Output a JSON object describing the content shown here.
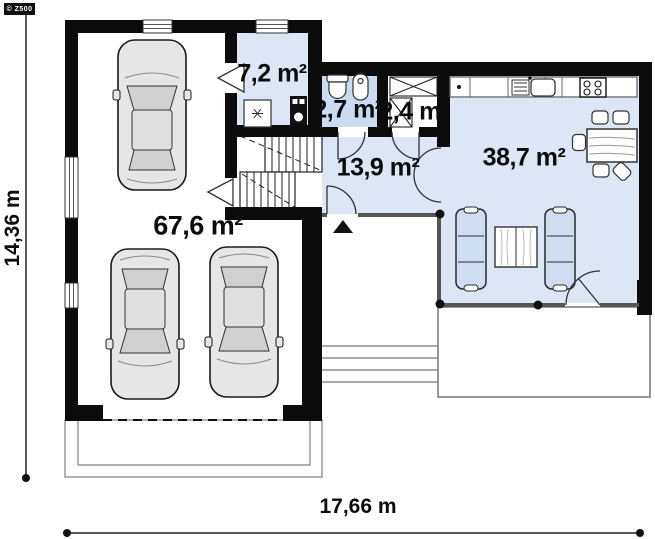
{
  "meta": {
    "brand_badge": "© Z500"
  },
  "plan": {
    "rooms": [
      {
        "id": "garage",
        "area_label": "67,6 m²"
      },
      {
        "id": "boiler-room",
        "area_label": "7,2 m²"
      },
      {
        "id": "bathroom",
        "area_label": "2,7 m²"
      },
      {
        "id": "wardrobe",
        "area_label": "2,4 m²"
      },
      {
        "id": "hall",
        "area_label": "13,9 m²"
      },
      {
        "id": "living-kitchen",
        "area_label": "38,7 m²"
      }
    ],
    "dimensions": {
      "total_width_label": "17,66 m",
      "total_height_label": "14,36 m"
    },
    "colors": {
      "wall": "#0b0b0b",
      "floor_blue": "#dce6f4",
      "bath_blue": "#ccdcf0",
      "sofa_blue": "#cfddf1"
    }
  }
}
